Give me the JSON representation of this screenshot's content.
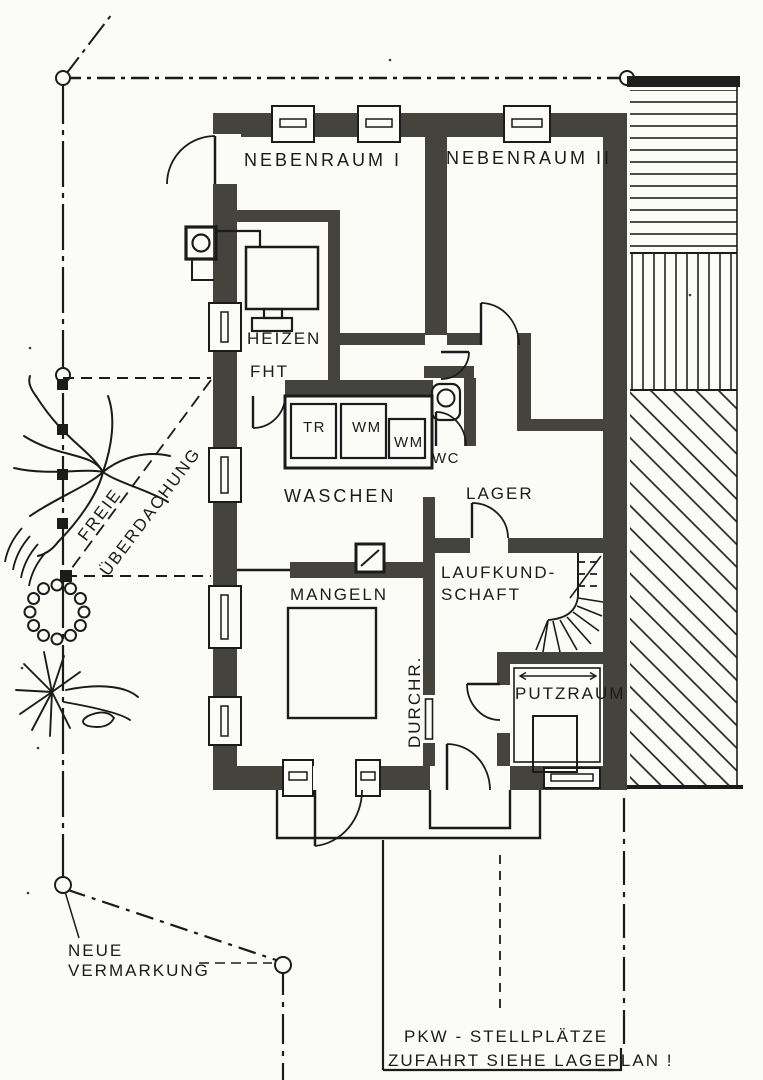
{
  "rooms": {
    "nebenraum1": "NEBENRAUM I",
    "nebenraum2": "NEBENRAUM II",
    "heizen": "HEIZEN",
    "fht": "FHT",
    "waschen": "WASCHEN",
    "wc": "WC",
    "lager": "LAGER",
    "mangeln": "MANGELN",
    "laufkund1": "LAUFKUND-",
    "laufkund2": "SCHAFT",
    "durchr": "DURCHR.",
    "putzraum": "PUTZRAUM"
  },
  "appliances": {
    "tr": "TR",
    "wm1": "WM",
    "wm2": "WM"
  },
  "site": {
    "freie1": "FREIE",
    "freie2": "ÜBERDACHUNG",
    "vermarkung1": "NEUE",
    "vermarkung2": "VERMARKUNG",
    "parking1": "PKW - STELLPLÄTZE",
    "parking2": "ZUFAHRT SIEHE LAGEPLAN !"
  },
  "colors": {
    "wall": "#45433e",
    "ink": "#1b1b1b",
    "paper": "#fbfbf8",
    "hatch": "#222222"
  }
}
